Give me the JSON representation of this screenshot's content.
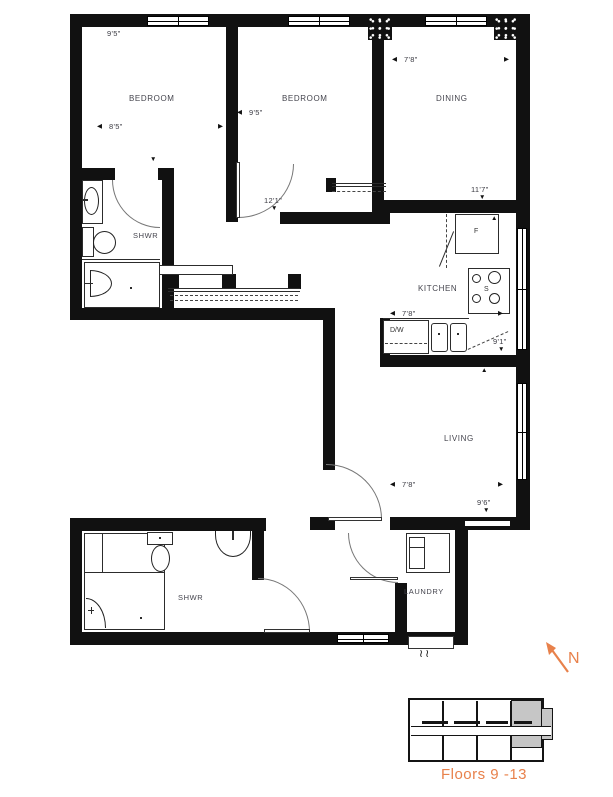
{
  "rooms": {
    "bedroom1": "BEDROOM",
    "bedroom2": "BEDROOM",
    "dining": "DINING",
    "shwr1": "SHWR",
    "kitchen": "KITCHEN",
    "living": "LIVING",
    "shwr2": "SHWR",
    "laundry": "LAUNDRY"
  },
  "dims": {
    "bed1_v": "9'5\"",
    "bed1_h": "8'5\"",
    "bed2_h": "9'5\"",
    "bed2_v": "12'1\"",
    "dining_h": "7'8\"",
    "dining_v": "11'7\"",
    "kitchen_h": "7'8\"",
    "kitchen_v": "9'1\"",
    "living_h": "7'8\"",
    "living_v": "9'6\""
  },
  "appliances": {
    "fridge": "F",
    "stove": "S",
    "dishwasher": "D/W"
  },
  "glyphs": {
    "up": "▲",
    "down": "▼",
    "left": "◀",
    "right": "▶",
    "squiggle": "≀≀"
  },
  "annotations": {
    "north": "N",
    "floors": "Floors 9 -13"
  },
  "colors": {
    "accent_orange": "#e8814b",
    "wall_black": "#111111",
    "keyplan_gray": "#c6c6c6",
    "label_gray": "#45454e"
  }
}
